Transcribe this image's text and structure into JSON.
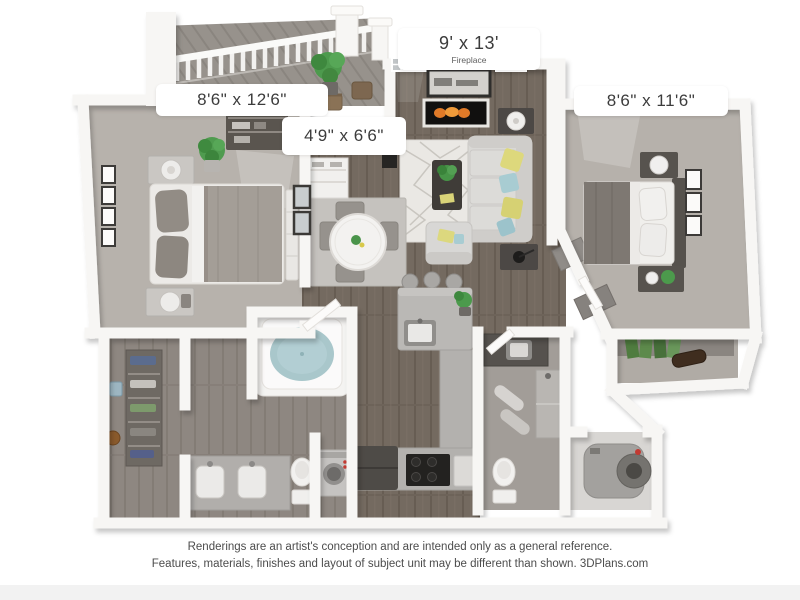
{
  "rooms": {
    "living_room": {
      "dimensions": "9' x 13'",
      "feature": "Fireplace"
    },
    "bedroom_left": {
      "dimensions": "8'6\" x 12'6\""
    },
    "dining_nook": {
      "dimensions": "4'9\" x 6'6\""
    },
    "bedroom_right": {
      "dimensions": "8'6\" x 11'6\""
    }
  },
  "disclaimer": {
    "line1": "Renderings are an artist's conception and are intended only as a general reference.",
    "line2": "Features, materials, finishes and layout of subject unit may be different than shown. 3DPlans.com"
  },
  "palette": {
    "background": "#ffffff",
    "wall": "#f7f6f4",
    "carpet": "#b7b2ac",
    "wood_floor": "#746a60",
    "bath_floor": "#8e8781",
    "balcony_floor": "#97928c",
    "living_rug": "#eae8e4",
    "dining_rug": "#c5c2be",
    "sofa": "#d9d8d5",
    "pillow_yellow": "#ddd87c",
    "pillow_blue": "#a8ccd2",
    "plant_green": "#4c9a4c",
    "tub_water": "#a9c7cb",
    "flame_orange": "#e8832a",
    "dark_furniture": "#4e4b47",
    "label_text": "#3c3c3c",
    "disclaimer_text": "#4c4c4c"
  }
}
